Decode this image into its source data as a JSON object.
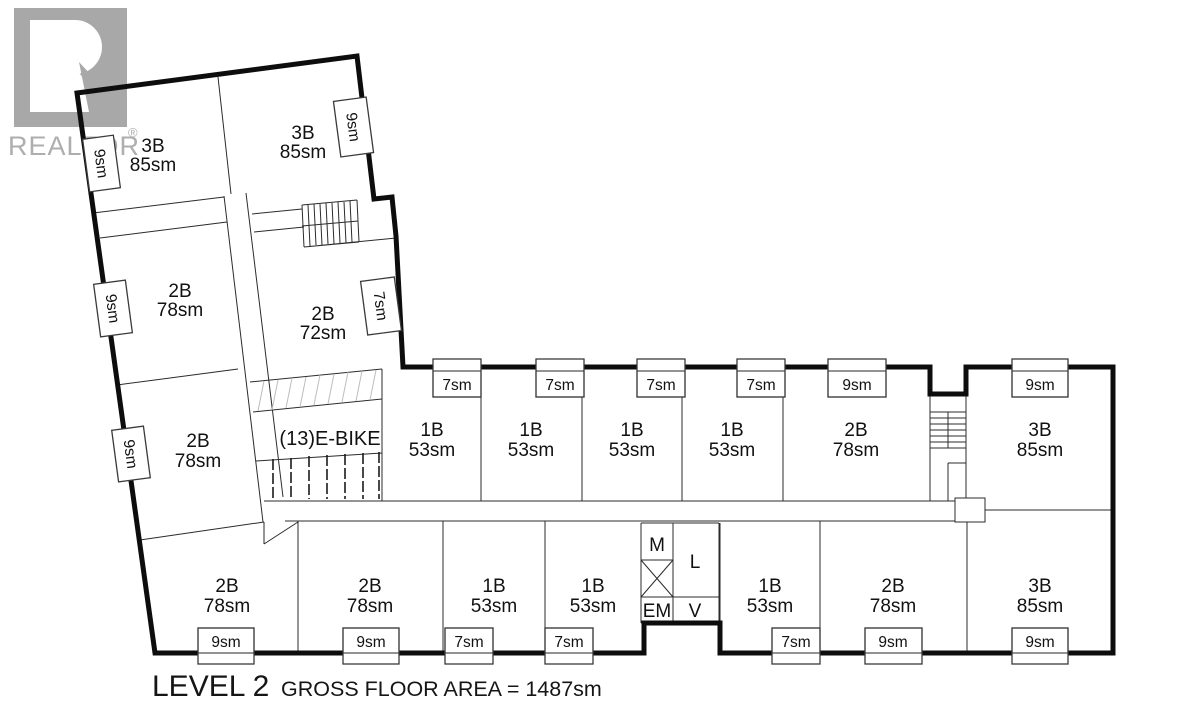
{
  "watermark": {
    "brand": "REALTOR",
    "registered": "®"
  },
  "plan": {
    "title_level": "LEVEL 2",
    "title_area": "GROSS FLOOR AREA = 1487sm",
    "ebike": "(13)E-BIKE",
    "core": {
      "m": "M",
      "l": "L",
      "em": "EM",
      "v": "V"
    },
    "units": [
      {
        "type": "3B",
        "area": "85sm",
        "balcony": "9sm"
      },
      {
        "type": "3B",
        "area": "85sm",
        "balcony": "9sm"
      },
      {
        "type": "2B",
        "area": "78sm",
        "balcony": "9sm"
      },
      {
        "type": "2B",
        "area": "72sm",
        "balcony": "7sm"
      },
      {
        "type": "2B",
        "area": "78sm",
        "balcony": "9sm"
      },
      {
        "type": "1B",
        "area": "53sm",
        "balcony": "7sm"
      },
      {
        "type": "1B",
        "area": "53sm",
        "balcony": "7sm"
      },
      {
        "type": "1B",
        "area": "53sm",
        "balcony": "7sm"
      },
      {
        "type": "1B",
        "area": "53sm",
        "balcony": "7sm"
      },
      {
        "type": "2B",
        "area": "78sm",
        "balcony": "9sm"
      },
      {
        "type": "3B",
        "area": "85sm",
        "balcony": "9sm"
      },
      {
        "type": "2B",
        "area": "78sm",
        "balcony": "9sm"
      },
      {
        "type": "2B",
        "area": "78sm",
        "balcony": "9sm"
      },
      {
        "type": "1B",
        "area": "53sm",
        "balcony": "7sm"
      },
      {
        "type": "1B",
        "area": "53sm",
        "balcony": "7sm"
      },
      {
        "type": "1B",
        "area": "53sm",
        "balcony": "7sm"
      },
      {
        "type": "2B",
        "area": "78sm",
        "balcony": "9sm"
      },
      {
        "type": "3B",
        "area": "85sm",
        "balcony": "9sm"
      }
    ]
  }
}
